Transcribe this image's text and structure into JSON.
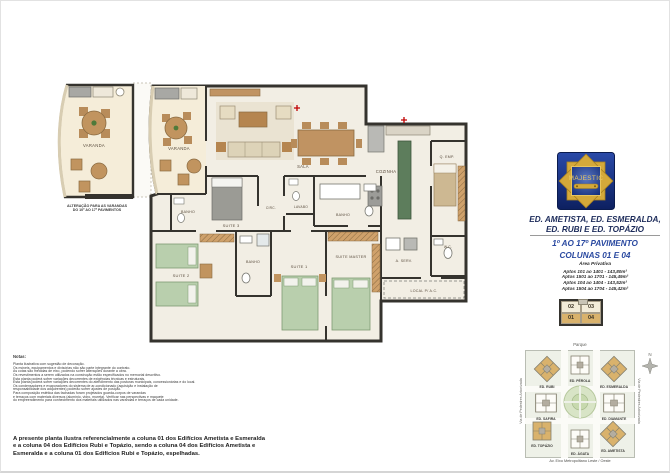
{
  "colors": {
    "accent_gold": "#d9b26c",
    "accent_blue": "#2a49a0",
    "navy": "#1c2b5a",
    "wall": "#35332e",
    "bed_green": "#b9cfad",
    "counter_green": "#5d7d5c",
    "logo_blue": "#16307c",
    "logo_gold": "#d4a93a",
    "ac_mark_red": "#c00000"
  },
  "alt_plan": {
    "room_label": "VARANDA",
    "caption_line1": "ALTERAÇÃO PARA AS VARANDAS",
    "caption_line2": "DO 10º AO 17º PAVIMENTOS"
  },
  "floor_plan": {
    "rooms": {
      "varanda": "VARANDA",
      "sala": "SALA",
      "cozinha": "COZINHA",
      "suite1": "SUITE 1",
      "suite2": "SUITE 2",
      "suite3": "SUITE 3",
      "suite_master": "SUITE MASTER",
      "banho1": "BANHO",
      "banho2": "BANHO",
      "banho_master": "BANHO",
      "lavabo": "LAVABO",
      "circ": "CIRC.",
      "q_emp": "Q. EMP.",
      "wc": "W.C.",
      "a_serv": "A. SERV.",
      "local_ac": "LOCAL P/ A.C."
    }
  },
  "logo": {
    "title": "MAJESTIC"
  },
  "header": {
    "buildings_line1": "ED. AMETISTA, ED. ESMERALDA,",
    "buildings_line2": "ED. RUBI E ED. TOPÁZIO",
    "floors": "1º AO 17º PAVIMENTO",
    "columns": "COLUNAS 01 E 04"
  },
  "private_area": {
    "title": "Área Privativa",
    "lines": [
      "Aptos 101 ao 1401 - 143,80m²",
      "Aptos 1501 ao 1701 - 145,49m²",
      "Aptos 104 ao 1404 - 143,52m²",
      "Aptos 1504 ao 1704 - 145,42m²"
    ]
  },
  "key_plan": {
    "top_left": "02",
    "top_right": "03",
    "bottom_left": "01",
    "bottom_right": "04"
  },
  "site_map": {
    "park": "Parque",
    "street_left": "Via de Pedestres Arborizada",
    "street_right": "Via de Pedestres Arborizada",
    "street_bottom": "Av. Eixo Metropolitano Leste / Oeste",
    "compass": "N",
    "buildings": [
      {
        "name": "ED. RUBI",
        "highlighted": true
      },
      {
        "name": "ED. PÉROLA",
        "highlighted": false
      },
      {
        "name": "ED. ESMERALDA",
        "highlighted": true
      },
      {
        "name": "ED. SAFIRA",
        "highlighted": false
      },
      {
        "name": "ED. DIAMANTE",
        "highlighted": false
      },
      {
        "name": "ED. TOPÁZIO",
        "highlighted": true
      },
      {
        "name": "ED. ÁGATA",
        "highlighted": false
      },
      {
        "name": "ED. AMETISTA",
        "highlighted": true
      }
    ]
  },
  "notes": {
    "title": "Notas:",
    "lines": [
      "Planta ilustrativa com sugestão de decoração.",
      "Os móveis, equipamentos e divisórias não são parte integrante do contrato.",
      "As cotas são medidas de eixo, podendo sofrer alterações durante a obra.",
      "Os revestimentos a serem utilizados na construção estão especificados no memorial descritivo.",
      "Esta planta poderá sofrer variações decorrentes de exigências técnicas e estruturais.",
      "Esta planta poderá sofrer variações decorrentes do atendimento das posturas municipais, concessionárias e do local.",
      "Os condensadores e evaporadores do sistema de ar-condicionado (aquisição e instalação de",
      "responsabilidade dos adquirentes) poderão sofrer ajustes de posição.",
      "Para composição estética das fachadas foram projetados guarda-corpos de varandas",
      "e terraços com materiais diversos (alumínio, vidro, mureta). Verificar nas perspectivas e maquete",
      "do empreendimento para conhecimento dos materiais utilizados nas varandas e terraços de cada unidade."
    ]
  },
  "disclaimer": {
    "lines": [
      "A presente planta ilustra referencialmente a coluna 01 dos Edifícios Ametista e Esmeralda",
      "e a coluna 04 dos  Edifícios  Rubi  e  Topázio,  sendo a coluna 04 dos Edifícios Ametista e",
      "Esmeralda e a coluna 01 dos Edifícios Rubi e Topázio, espelhadas."
    ]
  }
}
